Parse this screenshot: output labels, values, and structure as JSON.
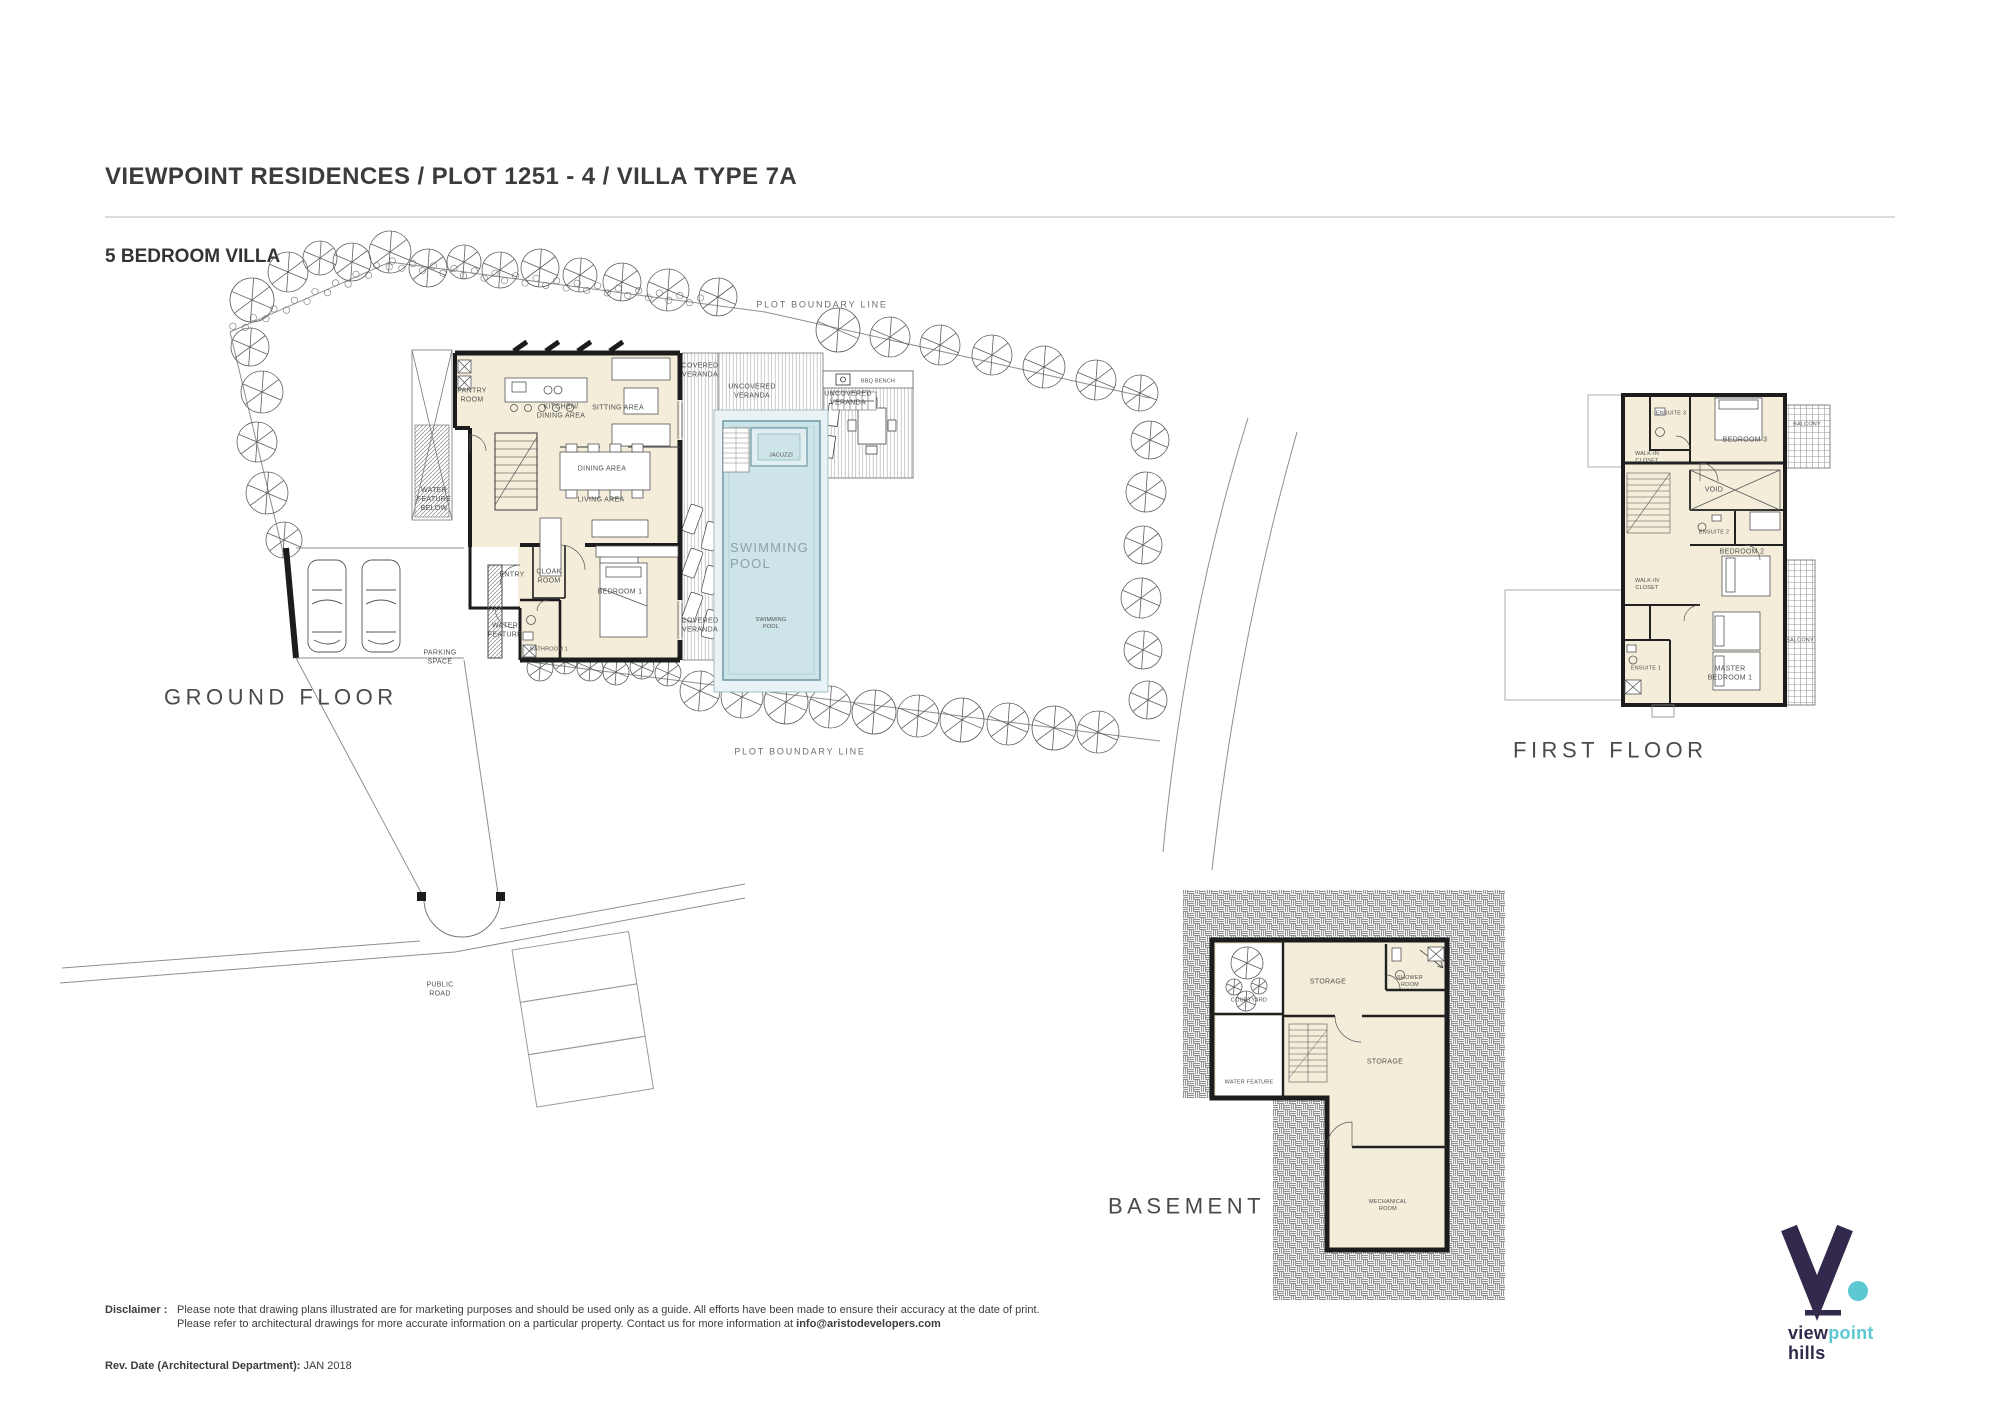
{
  "header": {
    "title": "VIEWPOINT RESIDENCES / PLOT 1251 - 4 / VILLA TYPE 7A",
    "subtitle": "5 BEDROOM VILLA"
  },
  "colors": {
    "pool_water": "#cde4e9",
    "pool_deck": "#e9f2f4",
    "room_fill": "#f3edda",
    "wall": "#1c1c1c",
    "logo_purple": "#33294d",
    "logo_teal": "#5cc8d2"
  },
  "labels": [
    {
      "t": "PLOT BOUNDARY LINE",
      "x": 822,
      "y": 305,
      "cls": "mid",
      "name": "plot-boundary-label-top"
    },
    {
      "t": "PLOT BOUNDARY LINE",
      "x": 800,
      "y": 752,
      "cls": "mid",
      "name": "plot-boundary-label-bottom"
    },
    {
      "t": "PANTRY\nROOM",
      "x": 472,
      "y": 396
    },
    {
      "t": "KITCHEN/\nDINING AREA",
      "x": 561,
      "y": 412
    },
    {
      "t": "SITTING AREA",
      "x": 618,
      "y": 409
    },
    {
      "t": "DINING AREA",
      "x": 602,
      "y": 470
    },
    {
      "t": "LIVING AREA",
      "x": 601,
      "y": 501
    },
    {
      "t": "WATER\nFEATURE\nBELOW",
      "x": 434,
      "y": 500
    },
    {
      "t": "ENTRY",
      "x": 512,
      "y": 576
    },
    {
      "t": "CLOAK\nROOM",
      "x": 549,
      "y": 577
    },
    {
      "t": "BEDROOM 1",
      "x": 620,
      "y": 593
    },
    {
      "t": "BATHROOM 1",
      "x": 549,
      "y": 650,
      "cls": "xs"
    },
    {
      "t": "WATER\nFEATURE",
      "x": 505,
      "y": 631
    },
    {
      "t": "PARKING\nSPACE",
      "x": 440,
      "y": 658
    },
    {
      "t": "COVERED\nVERANDA",
      "x": 700,
      "y": 371
    },
    {
      "t": "COVERED\nVERANDA",
      "x": 700,
      "y": 626
    },
    {
      "t": "UNCOVERED\nVERANDA",
      "x": 752,
      "y": 392
    },
    {
      "t": "UNCOVERED\nVERANDA",
      "x": 848,
      "y": 399
    },
    {
      "t": "BBQ BENCH",
      "x": 878,
      "y": 382,
      "cls": "xs"
    },
    {
      "t": "JACUZZI",
      "x": 781,
      "y": 456,
      "cls": "xs"
    },
    {
      "t": "SWIMMING\nPOOL",
      "x": 730,
      "y": 556,
      "cls": "pool",
      "name": "swimming-pool-label"
    },
    {
      "t": "SWIMMING\nPOOL",
      "x": 771,
      "y": 624,
      "cls": "xs"
    },
    {
      "t": "PUBLIC\nROAD",
      "x": 440,
      "y": 990
    },
    {
      "t": "GROUND FLOOR",
      "x": 164,
      "y": 697,
      "cls": "big",
      "name": "ground-floor-title"
    },
    {
      "t": "ENSUITE 3",
      "x": 1671,
      "y": 414,
      "cls": "xs"
    },
    {
      "t": "BEDROOM 3",
      "x": 1745,
      "y": 441
    },
    {
      "t": "BALCONY",
      "x": 1807,
      "y": 425,
      "cls": "xs"
    },
    {
      "t": "WALK-IN\nCLOSET",
      "x": 1647,
      "y": 458,
      "cls": "xs"
    },
    {
      "t": "VOID",
      "x": 1714,
      "y": 491
    },
    {
      "t": "ENSUITE 2",
      "x": 1714,
      "y": 533,
      "cls": "xs"
    },
    {
      "t": "BEDROOM 2",
      "x": 1742,
      "y": 553
    },
    {
      "t": "WALK-IN\nCLOSET",
      "x": 1647,
      "y": 585,
      "cls": "xs"
    },
    {
      "t": "ENSUITE 1",
      "x": 1646,
      "y": 669,
      "cls": "xs"
    },
    {
      "t": "MASTER\nBEDROOM 1",
      "x": 1730,
      "y": 674
    },
    {
      "t": "BALCONY",
      "x": 1800,
      "y": 641,
      "cls": "xs"
    },
    {
      "t": "FIRST FLOOR",
      "x": 1513,
      "y": 750,
      "cls": "big",
      "name": "first-floor-title"
    },
    {
      "t": "COURTYARD",
      "x": 1249,
      "y": 1001,
      "cls": "xs"
    },
    {
      "t": "STORAGE",
      "x": 1328,
      "y": 983
    },
    {
      "t": "SHOWER\nROOM",
      "x": 1410,
      "y": 982,
      "cls": "xs"
    },
    {
      "t": "STORAGE",
      "x": 1385,
      "y": 1063
    },
    {
      "t": "WATER FEATURE",
      "x": 1249,
      "y": 1083,
      "cls": "xs"
    },
    {
      "t": "MECHANICAL\nROOM",
      "x": 1388,
      "y": 1206,
      "cls": "xs"
    },
    {
      "t": "BASEMENT",
      "x": 1108,
      "y": 1206,
      "cls": "big",
      "name": "basement-title"
    }
  ],
  "footer": {
    "disclaimer_label": "Disclaimer :",
    "disclaimer_line1": "Please note that drawing plans illustrated are for marketing purposes and should be used only as a guide. All efforts have been made to ensure their accuracy at the date of print.",
    "disclaimer_line2": "Please refer to architectural drawings for more accurate information on a particular property. Contact us for more information at ",
    "disclaimer_email": "info@aristodevelopers.com",
    "rev_label": "Rev. Date (Architectural Department):",
    "rev_value": "JAN 2018"
  },
  "logo": {
    "word_primary": "view",
    "word_accent": "point",
    "word_secondary": "hills"
  }
}
